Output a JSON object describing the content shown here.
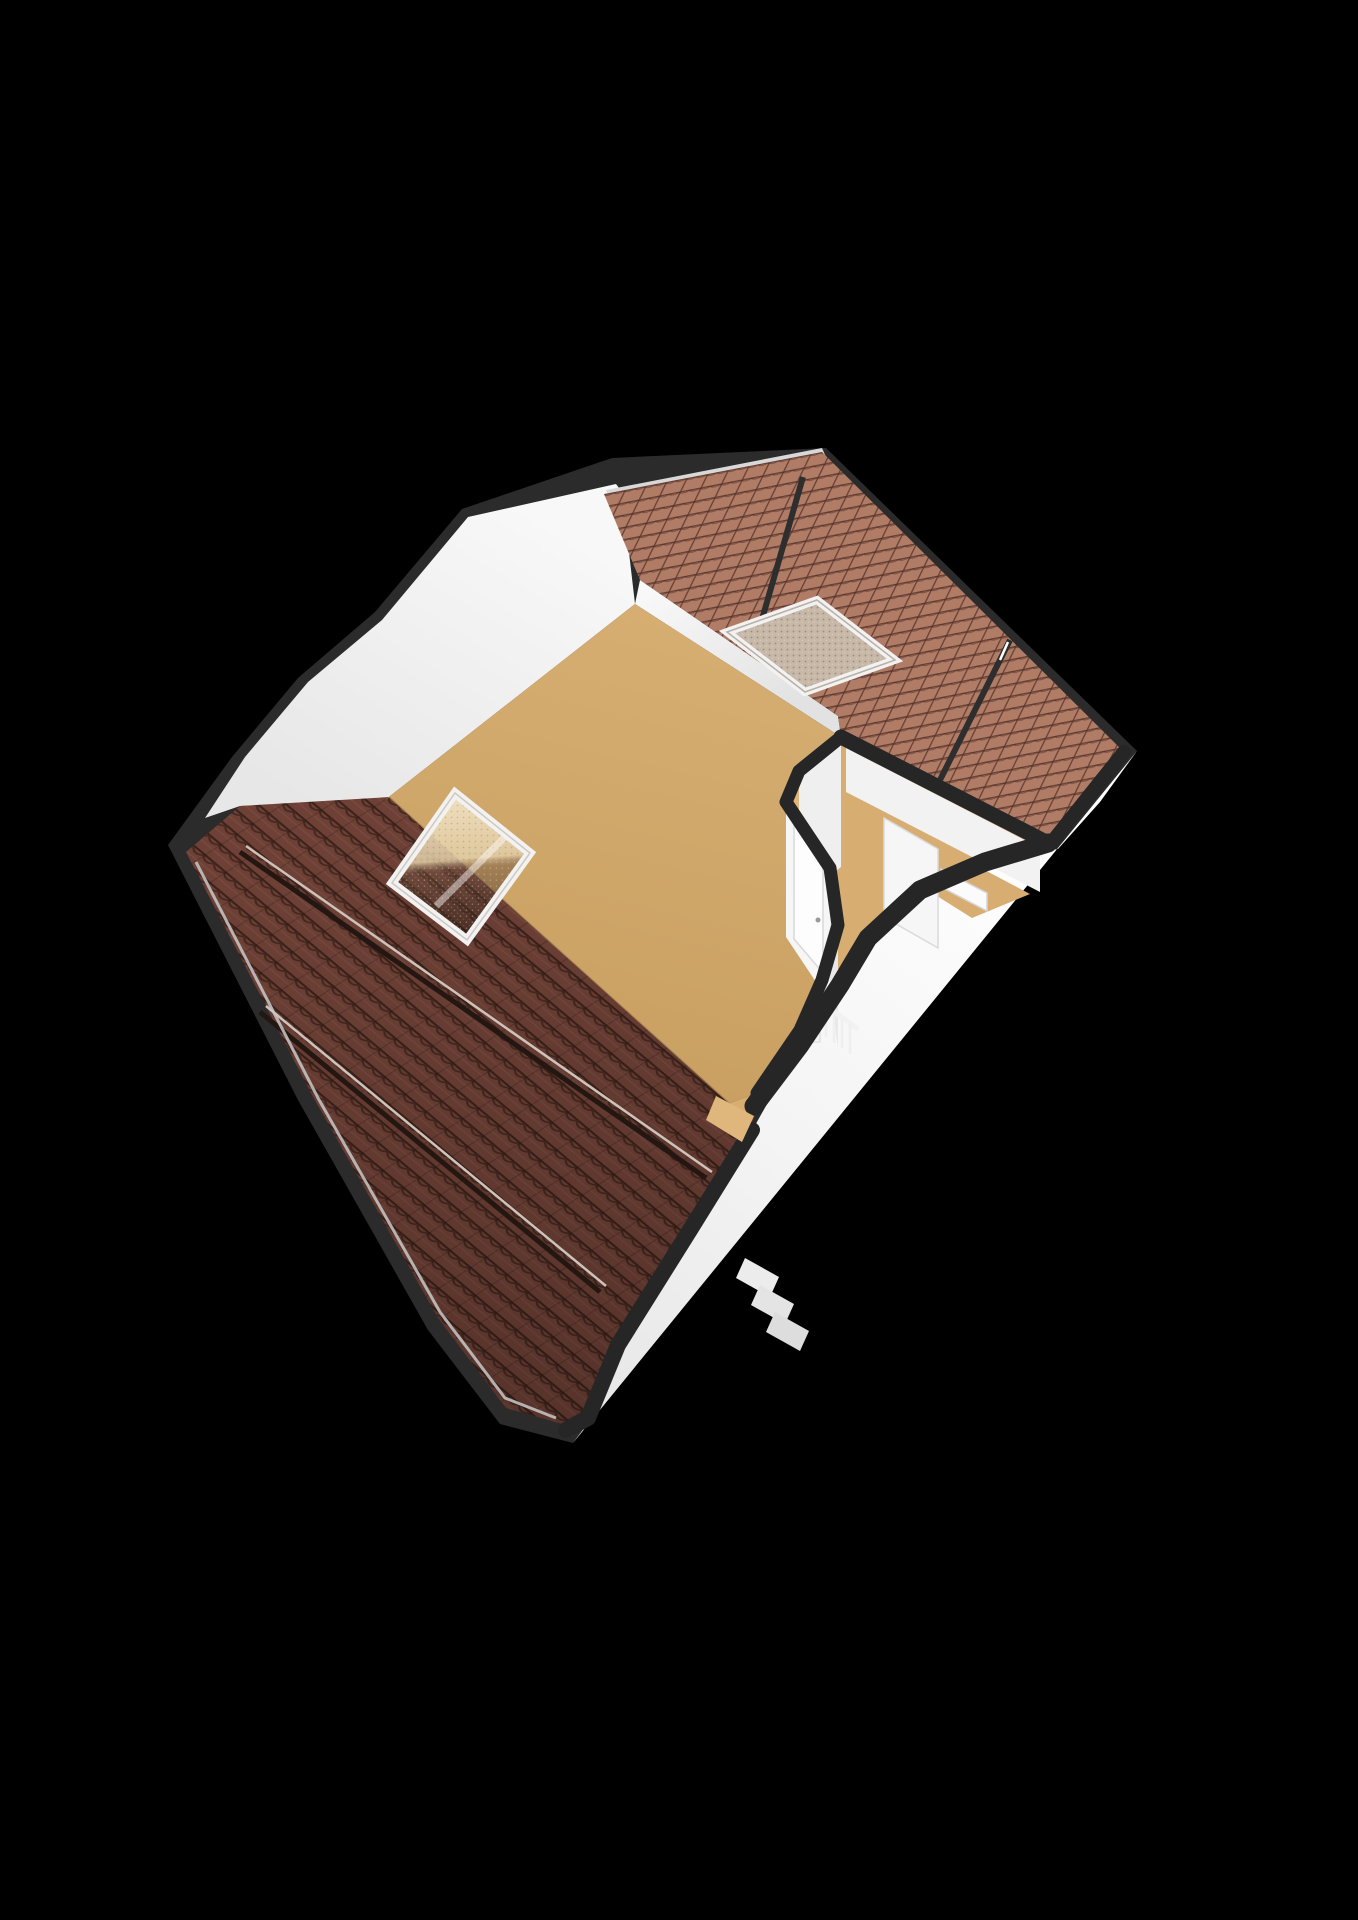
{
  "scene": {
    "kind": "floorplan-3d-render",
    "elements": [
      "roof-slope-large",
      "roof-band-upper",
      "roof-seam-lines",
      "skylight-window",
      "roof-square-window",
      "attic-floor",
      "gable-wall-left",
      "exterior-wall-right",
      "interior-partition",
      "interior-door",
      "open-doorway",
      "small-room",
      "white-fixture",
      "stair-railing",
      "steps-detail"
    ]
  },
  "colors": {
    "background": "#000000",
    "silhouette": "#2b2b2b",
    "band": "#262626",
    "roof_dark": "#6f4136",
    "roof_dark_line": "#3b221a",
    "roof_dark_scallop": "#452920",
    "roof_light": "#b17c66",
    "roof_light_line": "#6a4236",
    "floor_top": "#d6ae72",
    "floor_bottom": "#c89f60",
    "floor_hall": "#d7ad72",
    "wall_ochre": "#dfb67c",
    "wall_white": "#f6f6f6",
    "wall_white_dim": "#e8e8e8",
    "glass_speckled": "#c7b8a8",
    "glass_dot": "#887b6c",
    "window_frame": "#f2f2f2",
    "ridge_sliver": "#d8d8d8",
    "eave_highlight": "#c9c9c9",
    "seam_dark": "#241611",
    "seam_light": "#cdc3bb"
  }
}
